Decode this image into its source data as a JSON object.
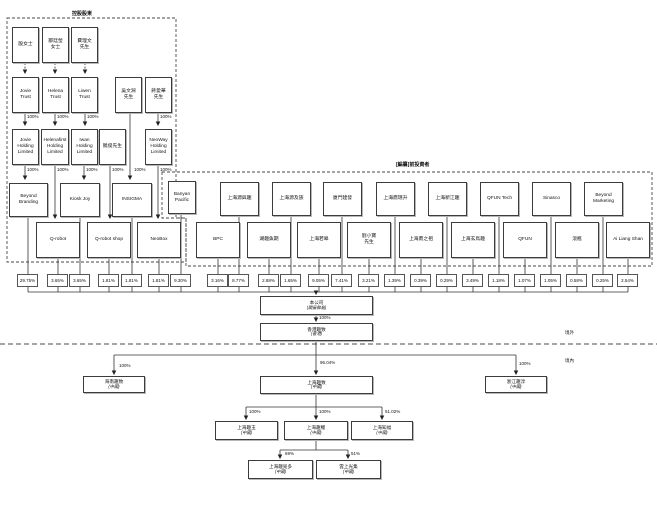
{
  "section_labels": {
    "controlling_shareholders": "控股股東",
    "pre_investors": "[編纂]前投資者",
    "offshore": "境外",
    "onshore": "境內"
  },
  "nodes": {
    "yin": "殷女士",
    "zou": "鄒廷瑩\n女士",
    "fei": "費理文\n先生",
    "jovie_trust": "Jovie\nTrust",
    "helena_trust": "Helena\nTrust",
    "liwen_trust": "Liwen\nTrust",
    "wu": "吳文淵\n先生",
    "jiang": "蔣愛華\n先生",
    "jovie_holding": "Jovie\nHolding\nLimited",
    "helena_holding": "Helenafirst\nHolding\nLimited",
    "iwan_holding": "Iwan\nHolding\nLimited",
    "rao": "饒俊先生",
    "neoway_holding": "NeoWay\nHolding\nLimited",
    "beyond_branding": "Beyond\nBranding",
    "kiosk_joy": "Kiosk Joy",
    "insigma": "INSIGMA",
    "banyan": "Banyan\nPacific",
    "sh_yuanyuqu": "上海源與趣",
    "sh_yuanjizu": "上海源及族",
    "xm_jianfa": "廈門建發",
    "sh_yingminsheng": "上海鷹珉升",
    "sh_xinjiangqu": "上海新江趣",
    "qfun_tech": "QFUN Tech",
    "sinasco": "Sinasco",
    "beyond_marketing": "Beyond\nMarketing",
    "qrobot": "Q-robot",
    "qrobot_shop": "Q-robot shop",
    "neobox": "NeoBox",
    "bpc": "BPC",
    "hu_quyuqi": "湖趣魚期",
    "sh_ruogao": "上海若皋",
    "liu": "劉小寶\n先生",
    "sh_yingzhizu": "上海鷹之祖",
    "sh_xuanniaoqu": "上海玄鳥趣",
    "qfun": "QFUN",
    "gunping": "滾瓶",
    "ai_liang_shan": "Ai Liang Shan",
    "company": {
      "label": "本公司",
      "note": "(開曼群島)"
    },
    "hk_quzhi": {
      "label": "香港趣致",
      "note": "(香港)"
    },
    "hainan_quzhi": {
      "label": "海南趣致",
      "note": "(中國)"
    },
    "shanghai_quzhi": {
      "label": "上海趣致",
      "note": "(中國)"
    },
    "zhejiang_quchun": {
      "label": "浙江趣淳",
      "note": "(中國)"
    },
    "sh_quyu": {
      "label": "上海趣玉",
      "note": "(中國)"
    },
    "sh_quli": {
      "label": "上海趣鯉",
      "note": "(中國)"
    },
    "sh_zhifu": {
      "label": "上海知福",
      "note": "(中國)"
    },
    "sh_qumiduo": {
      "label": "上海趣覓多",
      "note": "(中國)"
    },
    "yunshang": {
      "label": "雲上光集",
      "note": "(中國)"
    }
  },
  "ownership_pcts": [
    "29.75%",
    "3.65%",
    "3.65%",
    "1.81%",
    "1.81%",
    "1.81%",
    "9.30%",
    "3.16%",
    "8.77%",
    "2.88%",
    "1.65%",
    "9.05%",
    "7.41%",
    "3.21%",
    "1.39%",
    "0.39%",
    "0.29%",
    "3.49%",
    "1.18%",
    "1.07%",
    "1.05%",
    "0.58%",
    "0.25%",
    "2.54%"
  ],
  "edge_labels": {
    "p100": "100%",
    "p9604": "96.04%",
    "p5102": "51.02%",
    "p69": "69%",
    "p51": "51%"
  }
}
